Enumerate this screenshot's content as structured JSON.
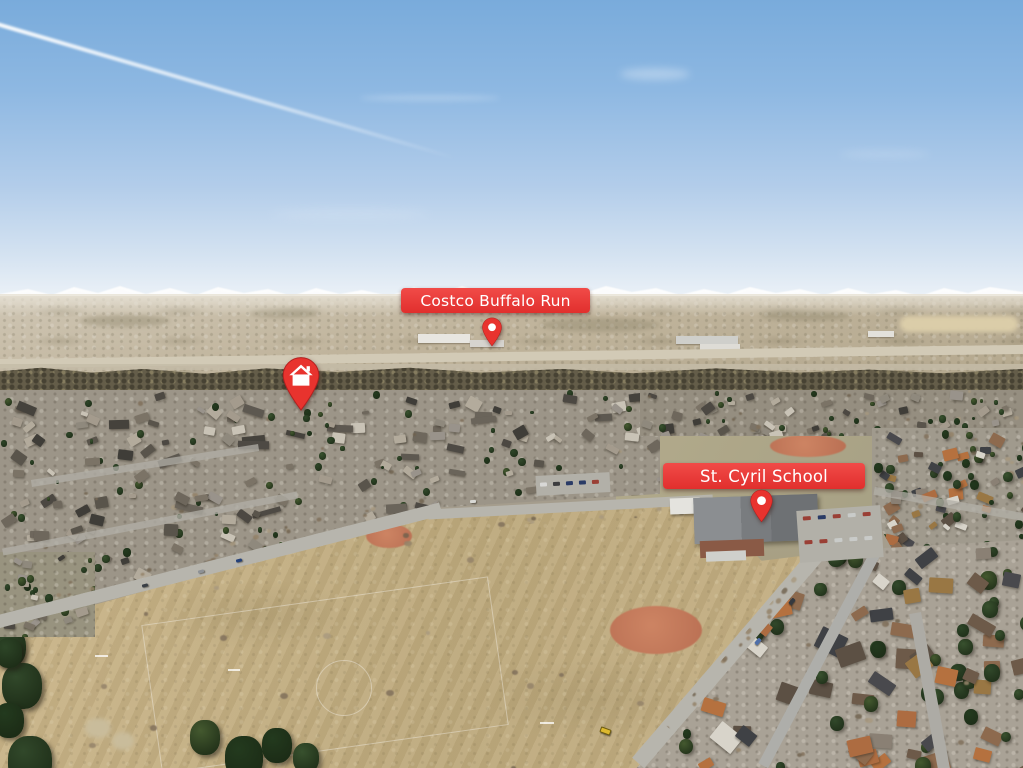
{
  "markers": {
    "costco": {
      "label": "Costco Buffalo Run",
      "icon": "map-pin-icon"
    },
    "school": {
      "label": "St. Cyril School",
      "icon": "map-pin-icon"
    },
    "home": {
      "icon": "home-pin-icon"
    }
  },
  "colors": {
    "marker_red": "#e8332e",
    "marker_text": "#ffffff"
  }
}
